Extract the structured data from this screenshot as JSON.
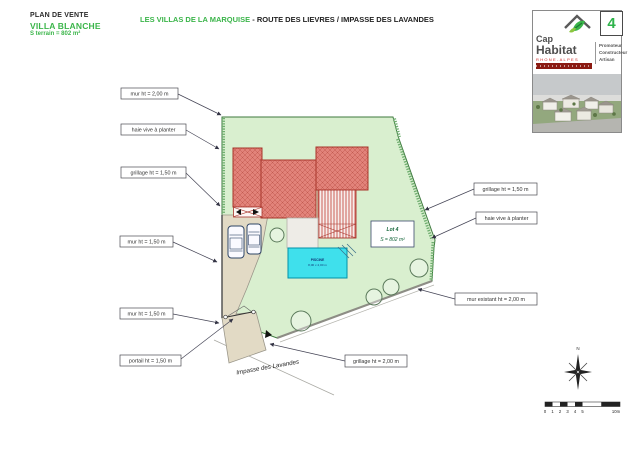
{
  "header": {
    "plan_type": "PLAN DE VENTE",
    "villa_name": "VILLA BLANCHE",
    "surface": "S terrain = 802 m²",
    "title_green": "LES VILLAS DE LA MARQUISE",
    "title_dark": " - ROUTE DES LIEVRES / IMPASSE DES LAVANDES",
    "lot_number": "4"
  },
  "logo": {
    "brand_line1": "Cap",
    "brand_line2": "Habitat",
    "region": "RHONE-ALPES",
    "tagline": [
      "Promoteur",
      "Constructeur",
      "Artisan"
    ]
  },
  "plan": {
    "labels_left": [
      "mur ht = 2,00 m",
      "haie vive à planter",
      "grillage ht = 1,50 m",
      "mur ht = 1,50 m",
      "mur ht = 1,50 m",
      "portail ht = 1,50 m"
    ],
    "labels_right": [
      "grillage ht = 1,50 m",
      "haie vive à planter",
      "mur existant ht = 2,00 m"
    ],
    "label_bottom": "grillage ht = 2,00 m",
    "lot_box": {
      "line1": "Lot 4",
      "line2": "S = 802 m²"
    },
    "pool": {
      "line1": "PISCINE",
      "line2": "8,00 x 4,00 m"
    },
    "street_name": "Impasse des Lavandes",
    "compass_north": "N",
    "scale_ticks": [
      "0",
      "1",
      "2",
      "3",
      "4",
      "5"
    ],
    "scale_end": "10m"
  },
  "colors": {
    "brand_green": "#3bb54a",
    "parcel_fill": "#d9efcf",
    "building_fill": "#e2837a",
    "building_hatch": "#c25a50",
    "pool_fill": "#3fe0ec",
    "driveway_fill": "#e2dac5",
    "banner_red": "#8b1a12",
    "region_red": "#cc2222"
  }
}
